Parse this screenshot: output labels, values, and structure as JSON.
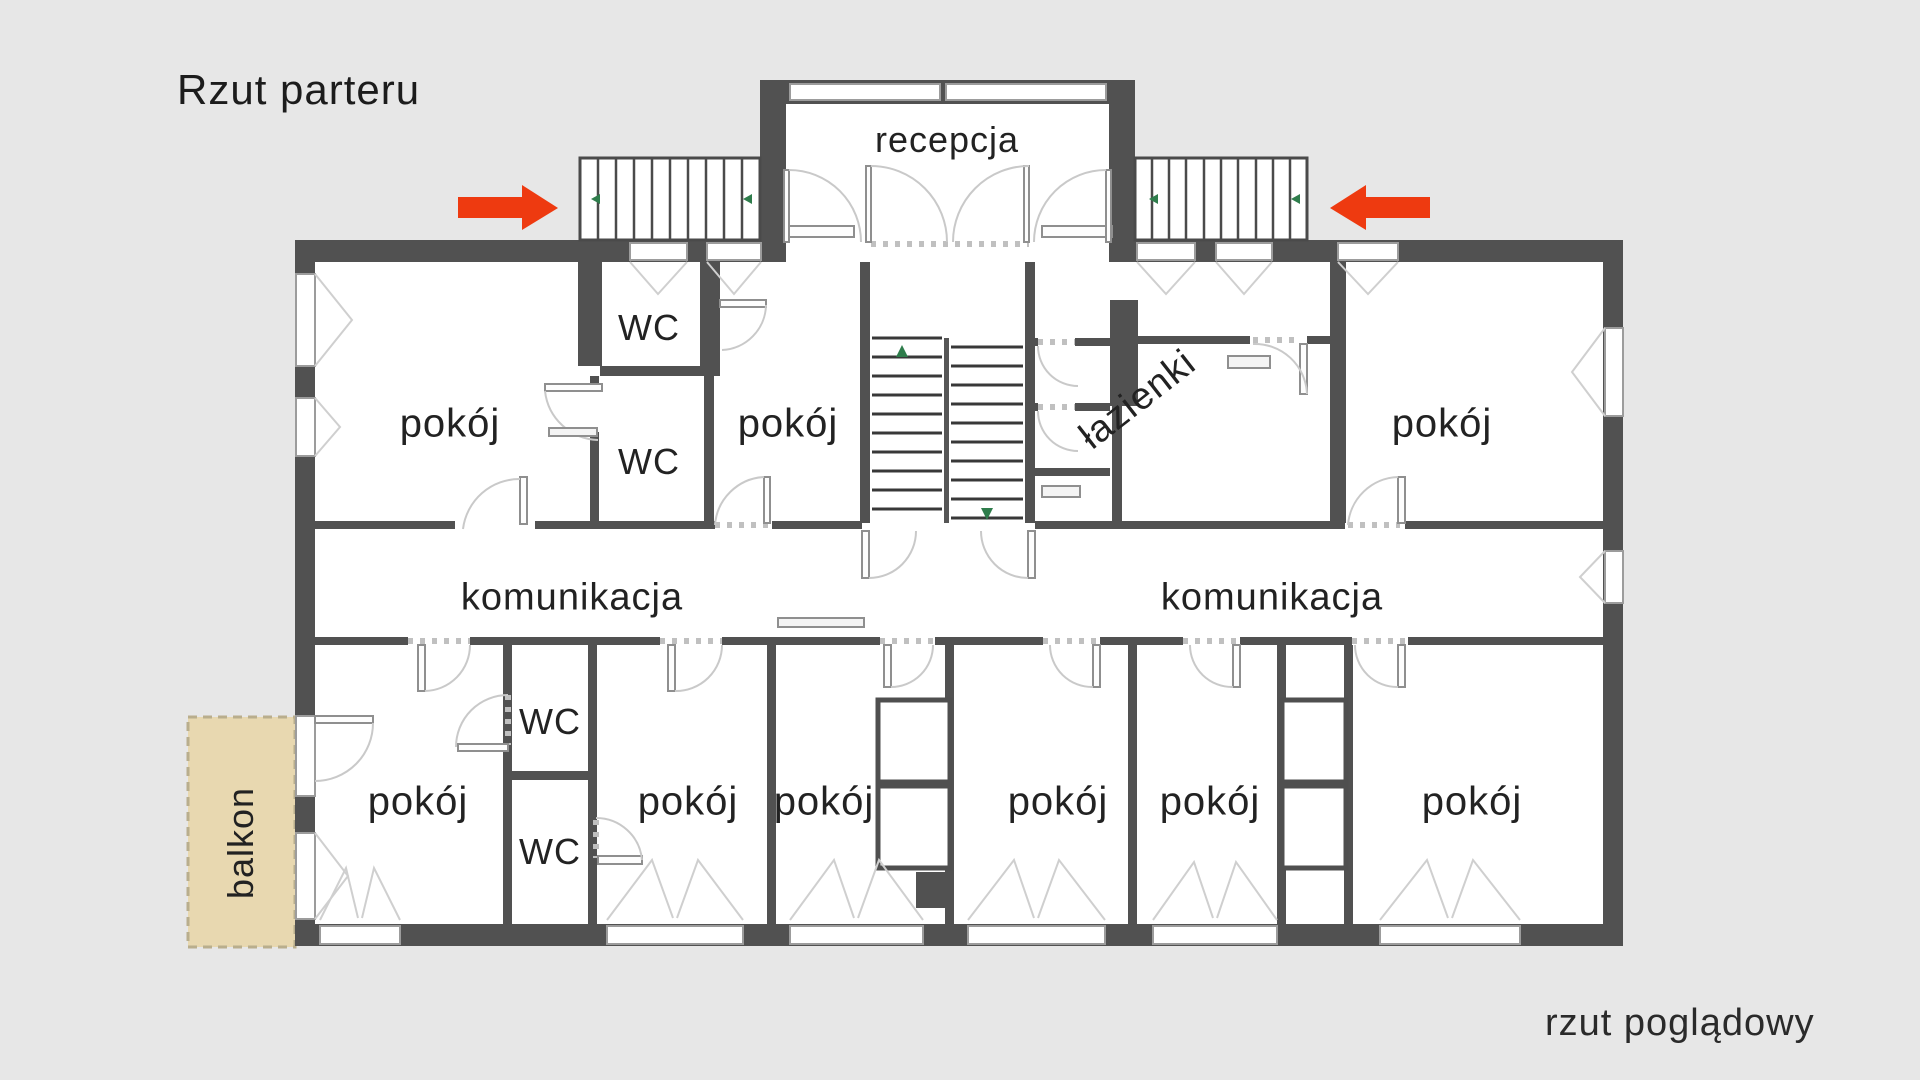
{
  "title": "Rzut parteru",
  "caption": "rzut poglądowy",
  "colors": {
    "background": "#e7e7e7",
    "wall": "#515151",
    "room_fill": "#ffffff",
    "door_arc": "#c9c9c9",
    "arrow_red": "#ee3a10",
    "balcony_fill": "#e8d8b0",
    "balcony_border": "#b9ae8d",
    "stair_marker_green": "#2f7d4c",
    "text": "#222222"
  },
  "room_labels": [
    {
      "id": "reception",
      "text": "recepcja",
      "x": 947,
      "y": 140,
      "size": 36,
      "rotate": 0
    },
    {
      "id": "wc-top-1",
      "text": "WC",
      "x": 649,
      "y": 328,
      "size": 36,
      "rotate": 0
    },
    {
      "id": "wc-top-2",
      "text": "WC",
      "x": 649,
      "y": 462,
      "size": 36,
      "rotate": 0
    },
    {
      "id": "room-top-left",
      "text": "pokój",
      "x": 450,
      "y": 424,
      "size": 40,
      "rotate": 0
    },
    {
      "id": "room-top-middle",
      "text": "pokój",
      "x": 788,
      "y": 424,
      "size": 40,
      "rotate": 0
    },
    {
      "id": "bathrooms",
      "text": "łazienki",
      "x": 1138,
      "y": 400,
      "size": 38,
      "rotate": -38
    },
    {
      "id": "room-top-right",
      "text": "pokój",
      "x": 1442,
      "y": 424,
      "size": 40,
      "rotate": 0
    },
    {
      "id": "corridor-left",
      "text": "komunikacja",
      "x": 572,
      "y": 598,
      "size": 38,
      "rotate": 0
    },
    {
      "id": "corridor-right",
      "text": "komunikacja",
      "x": 1272,
      "y": 598,
      "size": 38,
      "rotate": 0
    },
    {
      "id": "room-bottom-1",
      "text": "pokój",
      "x": 418,
      "y": 802,
      "size": 40,
      "rotate": 0
    },
    {
      "id": "wc-bottom-1",
      "text": "WC",
      "x": 550,
      "y": 722,
      "size": 36,
      "rotate": 0
    },
    {
      "id": "wc-bottom-2",
      "text": "WC",
      "x": 550,
      "y": 852,
      "size": 36,
      "rotate": 0
    },
    {
      "id": "room-bottom-2",
      "text": "pokój",
      "x": 688,
      "y": 802,
      "size": 40,
      "rotate": 0
    },
    {
      "id": "room-bottom-3",
      "text": "pokój",
      "x": 824,
      "y": 802,
      "size": 40,
      "rotate": 0
    },
    {
      "id": "room-bottom-4",
      "text": "pokój",
      "x": 1058,
      "y": 802,
      "size": 40,
      "rotate": 0
    },
    {
      "id": "room-bottom-5",
      "text": "pokój",
      "x": 1210,
      "y": 802,
      "size": 40,
      "rotate": 0
    },
    {
      "id": "room-bottom-6",
      "text": "pokój",
      "x": 1472,
      "y": 802,
      "size": 40,
      "rotate": 0
    },
    {
      "id": "balcony",
      "text": "balkon",
      "x": 241,
      "y": 843,
      "size": 36,
      "rotate": -90
    }
  ]
}
